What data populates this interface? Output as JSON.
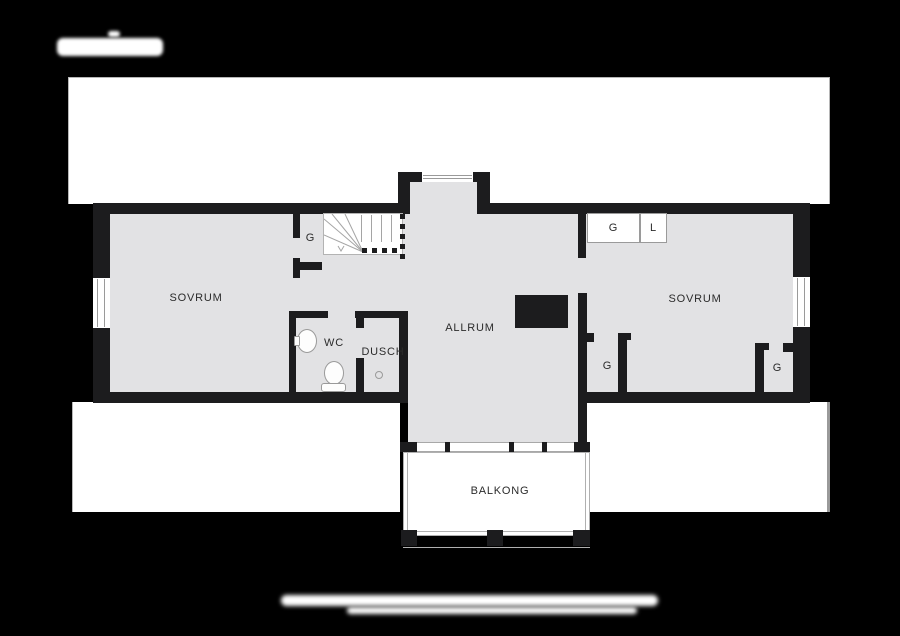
{
  "plan": {
    "rooms": {
      "sovrum_left": "SOVRUM",
      "allrum": "ALLRUM",
      "wc": "WC",
      "dusch": "DUSCH",
      "sovrum_right": "SOVRUM",
      "balkong": "BALKONG"
    },
    "closets": {
      "stair_closet": "G",
      "wardrobe_g": "G",
      "wardrobe_l": "L",
      "right_closet_left": "G",
      "right_closet_right": "G"
    }
  },
  "colors": {
    "background": "#000000",
    "roof_band": "#ffffff",
    "floor": "#e2e2e4",
    "wall": "#1c1c1e",
    "furniture_outline": "#9a9a9a",
    "label_text": "#2b2b2b"
  }
}
